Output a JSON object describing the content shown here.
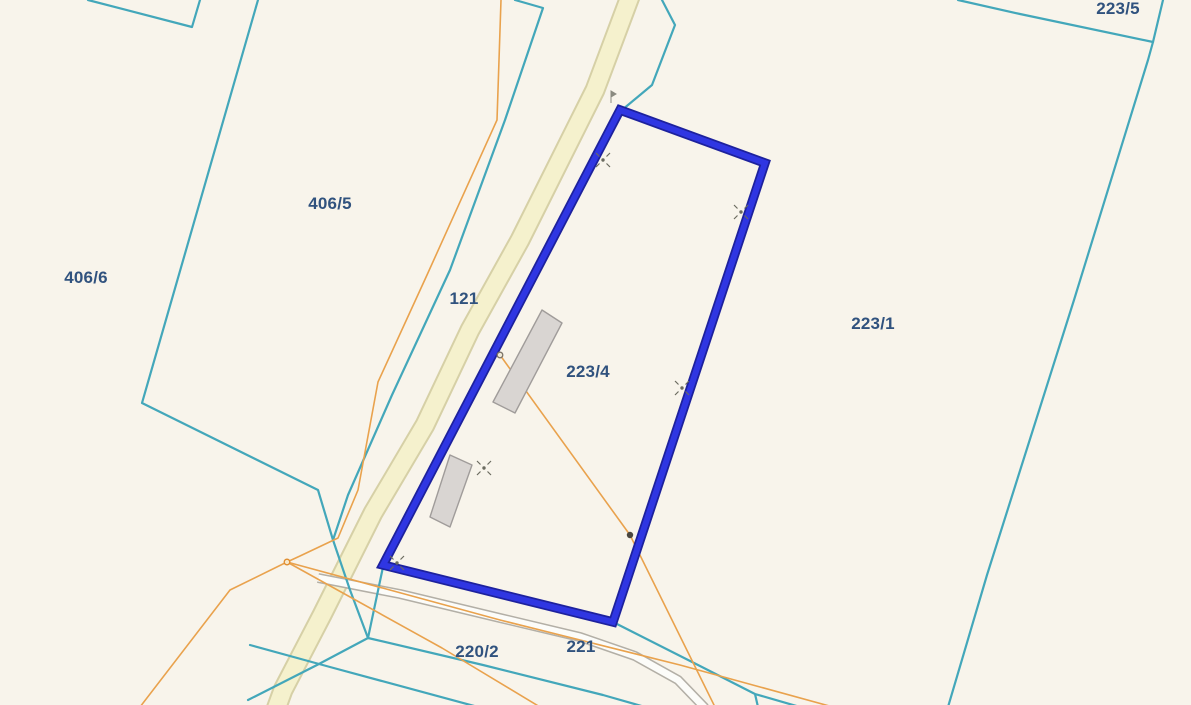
{
  "map": {
    "type": "cadastral-parcel-map",
    "background_color": "#f8f4eb",
    "boundary_color": "#43a7ba",
    "highlight_color": "#2f36e2",
    "highlight_casing_color": "#1d219d",
    "road_fill_color": "#f5f1cd",
    "road_edge_color": "#d6d0a6",
    "path_fill_color": "#fcfcf9",
    "path_edge_color": "#b3afa6",
    "utility_line_color": "#e9a24d",
    "building_fill_color": "#d9d5d2",
    "building_edge_color": "#a09c9a",
    "survey_marker_color": "#6b6b60",
    "label_color": "#30527e",
    "highlighted_parcel": "223/4",
    "parcels": [
      {
        "label": "223/5",
        "x": 1118,
        "y": 9
      },
      {
        "label": "406/5",
        "x": 330,
        "y": 204
      },
      {
        "label": "406/6",
        "x": 86,
        "y": 278
      },
      {
        "label": "121",
        "x": 464,
        "y": 299
      },
      {
        "label": "223/4",
        "x": 588,
        "y": 372
      },
      {
        "label": "223/1",
        "x": 873,
        "y": 324
      },
      {
        "label": "220/2",
        "x": 477,
        "y": 652
      },
      {
        "label": "221",
        "x": 581,
        "y": 647
      }
    ],
    "survey_markers": [
      {
        "x": 603,
        "y": 160
      },
      {
        "x": 741,
        "y": 212
      },
      {
        "x": 682,
        "y": 388
      },
      {
        "x": 484,
        "y": 468
      },
      {
        "x": 397,
        "y": 563
      }
    ],
    "utility_poles": [
      {
        "x": 500,
        "y": 355,
        "style": "open"
      },
      {
        "x": 630,
        "y": 535,
        "style": "filled"
      },
      {
        "x": 287,
        "y": 562,
        "style": "orange"
      }
    ],
    "buildings_count": 2
  }
}
